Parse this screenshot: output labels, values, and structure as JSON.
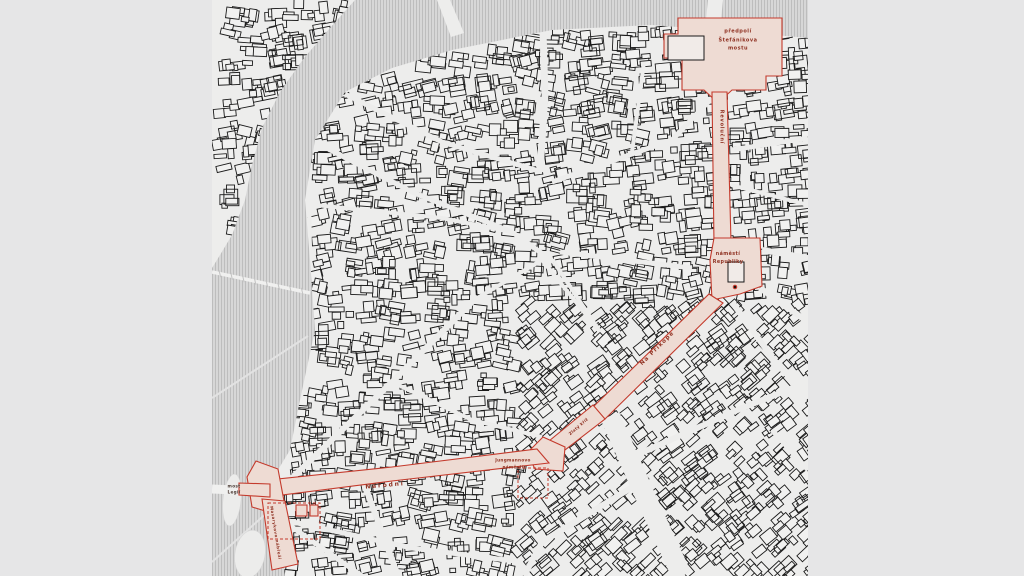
{
  "figure": {
    "kind": "figure-ground city map with highlighted street corridor",
    "background_color": "#e6e6e7",
    "land_color": "#ededec",
    "river_color": "#d7d7d7",
    "river_hatch_color": "#bdbdbd",
    "building_stroke": "#1a1a1a",
    "highlight_fill": "#eedbd3",
    "highlight_stroke": "#c43a2c",
    "label_color": "#8f3122"
  },
  "map": {
    "labels": {
      "predpoli": {
        "text": "předpolí\nŠtefánikova\nmostu"
      },
      "revolucni": {
        "text": "Revoluční"
      },
      "namrep": {
        "text": "náměstí\nRepubliky"
      },
      "naprikope": {
        "text": "Na Příkopě"
      },
      "zlatykriz": {
        "text": "Zlatý kříž"
      },
      "jungmannovo": {
        "text": "Jungmannovo\nnáměstí"
      },
      "narodni": {
        "text": "Národní"
      },
      "mostlegii": {
        "text": "most\nLegií"
      },
      "masarykovo": {
        "text": "Masarykovo nábřeží"
      }
    }
  }
}
